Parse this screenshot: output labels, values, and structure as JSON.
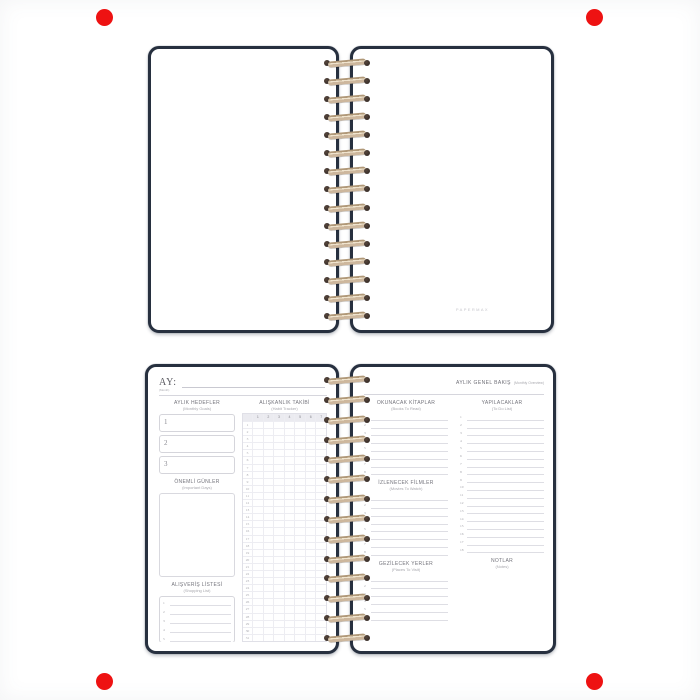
{
  "markers": {
    "color": "#ee1212",
    "positions": [
      "top-left",
      "top-right",
      "bottom-left",
      "bottom-right"
    ]
  },
  "colors": {
    "cover": "#27303f",
    "coil": "#cdb79d",
    "coil_hole": "#2b2320"
  },
  "spiral": {
    "loops_top": 15,
    "loops_bottom": 14
  },
  "top_notebook": {
    "brand_mark": "PAPERMAX"
  },
  "bottom_notebook": {
    "left_page": {
      "month_label": "AY:",
      "month_sublabel": "(Month)",
      "goals": {
        "title": "AYLIK HEDEFLER",
        "subtitle": "(Monthly Goals)",
        "count": 3
      },
      "important_days": {
        "title": "ÖNEMLİ GÜNLER",
        "subtitle": "(Important Days)"
      },
      "shopping": {
        "title": "ALIŞVERİŞ LİSTESİ",
        "subtitle": "(Shopping List)",
        "rows": 5
      },
      "habit": {
        "title": "ALIŞKANLIK TAKİBİ",
        "subtitle": "(Habit Tracker)",
        "day_columns": [
          "1",
          "2",
          "3",
          "4",
          "5",
          "6",
          "7"
        ],
        "rows": 31
      }
    },
    "right_page": {
      "header_title": "AYLIK GENEL BAKIŞ",
      "header_note": "(Monthly Overview)",
      "books": {
        "title": "OKUNACAK KİTAPLAR",
        "subtitle": "(Books To Read)",
        "rows": 8
      },
      "movies": {
        "title": "İZLENECEK FİLMLER",
        "subtitle": "(Movies To Watch)",
        "rows": 8
      },
      "places": {
        "title": "GEZİLECEK YERLER",
        "subtitle": "(Places To Visit)",
        "rows": 6
      },
      "todo": {
        "title": "YAPILACAKLAR",
        "subtitle": "(To Do List)",
        "rows": 18
      },
      "notes": {
        "title": "NOTLAR",
        "subtitle": "(Notes)"
      }
    }
  }
}
